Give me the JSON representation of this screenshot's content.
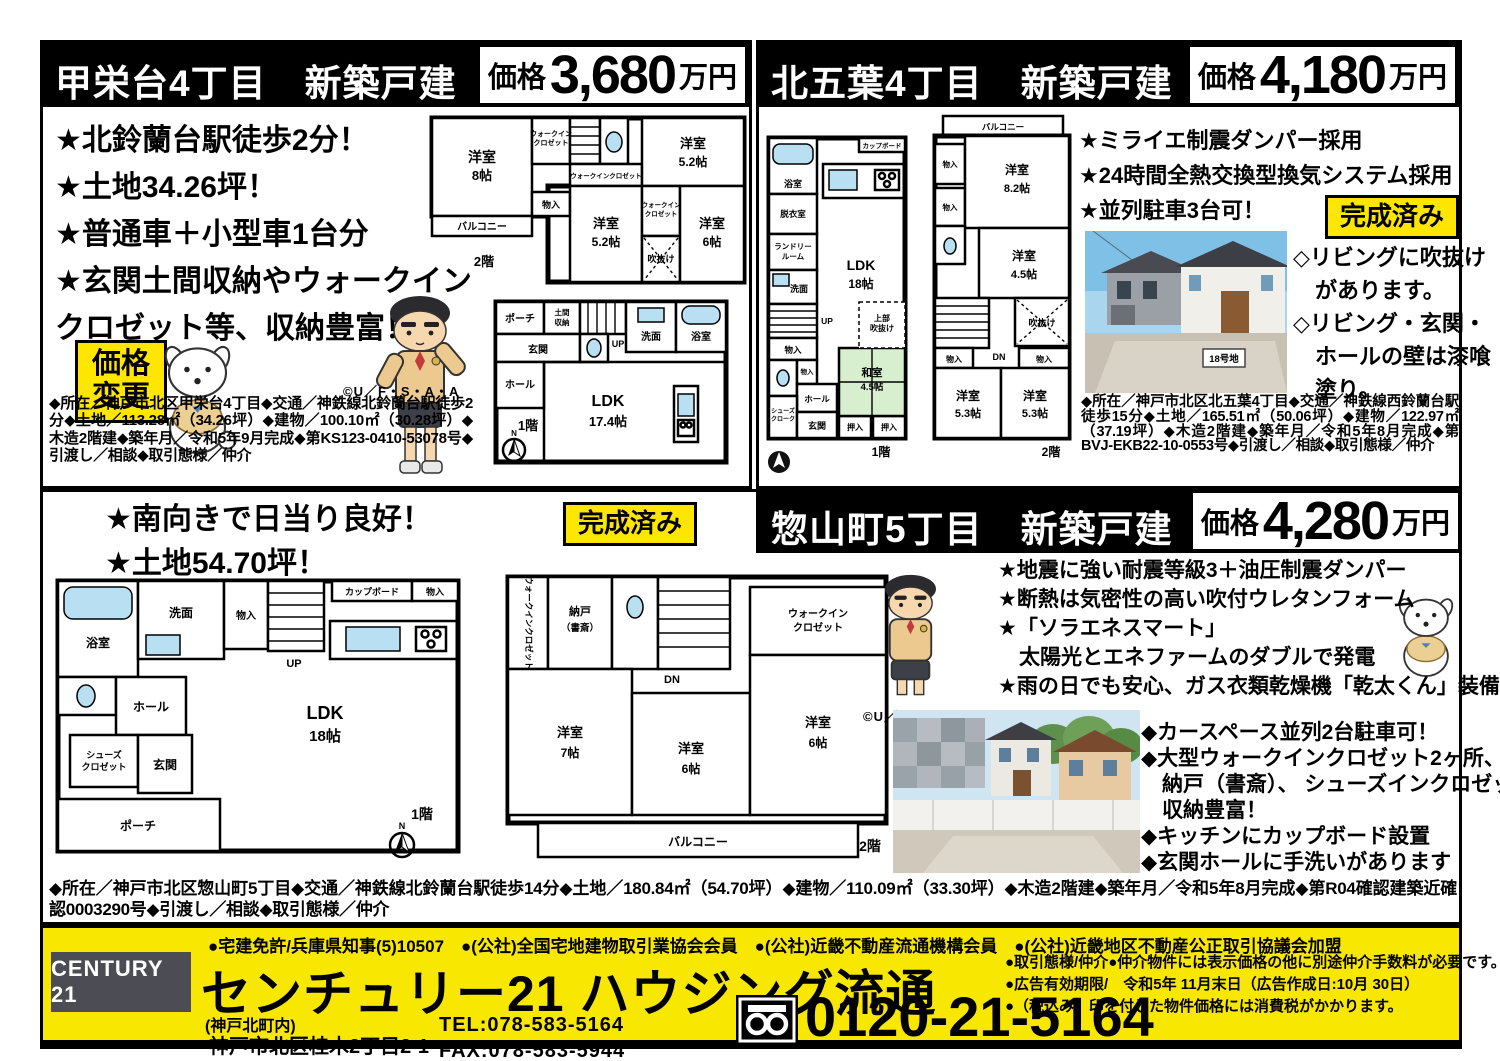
{
  "p1": {
    "title": "甲栄台4丁目　新築戸建",
    "price_label": "価格",
    "price": "3,680",
    "unit": "万円",
    "bullets": [
      "★北鈴蘭台駅徒歩2分！",
      "★土地34.26坪！",
      "★普通車＋小型車1台分",
      "★玄関土間収納やウォークイン",
      "クロゼット等、収納豊富！"
    ],
    "badge1": "価格",
    "badge2": "変更",
    "copyright": "©U／F・S・A・A",
    "details": "◆所在／神戸市北区甲栄台4丁目◆交通／神鉄線北鈴蘭台駅徒歩2分◆土地／113.28㎡（34.26坪）◆建物／100.10㎡（30.28坪）◆木造2階建◆築年月／令和5年9月完成◆第KS123-0410-53078号◆引渡し／相談◆取引態様／仲介",
    "plan2f": {
      "floor": "2階",
      "balcony": "バルコニー",
      "r1a": "洋室",
      "r1b": "8帖",
      "wic1a": "ウォークイン",
      "wic1b": "クロゼット",
      "wic2": "ウォークインクロゼット",
      "r2a": "洋室",
      "r2b": "5.2帖",
      "mono": "物入",
      "r3a": "洋室",
      "r3b": "5.2帖",
      "wic3a": "ウォークイン",
      "wic3b": "クロゼット",
      "void": "吹抜け",
      "r4a": "洋室",
      "r4b": "6帖"
    },
    "plan1f": {
      "floor": "1階",
      "porch": "ポーチ",
      "domaa": "土間",
      "domab": "収納",
      "genkan": "玄関",
      "up": "UP",
      "senmen": "洗面",
      "bath": "浴室",
      "hall": "ホール",
      "ldka": "LDK",
      "ldkb": "17.4帖",
      "north": "N"
    }
  },
  "p2": {
    "title": "北五葉4丁目　新築戸建",
    "price_label": "価格",
    "price": "4,180",
    "unit": "万円",
    "bullets": [
      "★ミライエ制震ダンパー採用",
      "★24時間全熱交換型換気システム採用",
      "★並列駐車3台可！"
    ],
    "badge": "完成済み",
    "sign": "18号地",
    "diamonds": [
      "◇リビングに吹抜け",
      "　があります。",
      "◇リビング・玄関・",
      "　ホールの壁は漆喰",
      "　塗り。"
    ],
    "details": "◆所在／神戸市北区北五葉4丁目◆交通／神鉄線西鈴蘭台駅徒歩15分◆土地／165.51㎡（50.06坪）◆建物／122.97㎡（37.19坪）◆木造2階建◆築年月／令和5年8月完成◆第BVJ-EKB22-10-0553号◆引渡し／相談◆取引態様／仲介",
    "plan": {
      "f1": "1階",
      "f2": "2階",
      "bath": "浴室",
      "datsui": "脱衣室",
      "laundrya": "ランドリー",
      "laundryb": "ルーム",
      "senmen": "洗面",
      "up": "UP",
      "mono1": "物入",
      "mono2": "物入",
      "hall": "ホール",
      "shoesa": "シューズ",
      "shoesb": "クローク",
      "genkan": "玄関",
      "oshi1": "押入",
      "oshi2": "押入",
      "washitsua": "和室",
      "washitsub": "4.5帖",
      "ldka": "LDK",
      "ldkb": "18帖",
      "cup": "カップボード",
      "voida": "上部",
      "voidb": "吹抜け",
      "balcony": "バルコニー",
      "mono3": "物入",
      "mono4": "物入",
      "r1a": "洋室",
      "r1b": "8.2帖",
      "r2a": "洋室",
      "r2b": "4.5帖",
      "void2": "吹抜け",
      "dn": "DN",
      "mono5": "物入",
      "mono6": "物入",
      "r3a": "洋室",
      "r3b": "5.3帖",
      "r4a": "洋室",
      "r4b": "5.3帖"
    }
  },
  "p3": {
    "title": "惣山町5丁目　新築戸建",
    "price_label": "価格",
    "price": "4,280",
    "unit": "万円",
    "left_bullets": [
      "★南向きで日当り良好！",
      "★土地54.70坪！"
    ],
    "badge": "完成済み",
    "bullets": [
      "★地震に強い耐震等級3＋油圧制震ダンパー",
      "★断熱は気密性の高い吹付ウレタンフォーム",
      "★「ソラエネスマート」",
      "　太陽光とエネファームのダブルで発電",
      "★雨の日でも安心、ガス衣類乾燥機「乾太くん」装備"
    ],
    "copyright": "©U／F・S・A・A",
    "diamonds": [
      "◆カースペース並列2台駐車可！",
      "◆大型ウォークインクロゼット2ヶ所、",
      "　納戸（書斎）、 シューズインクロゼットなど",
      "　収納豊富！",
      "◆キッチンにカップボード設置",
      "◆玄関ホールに手洗いがあります"
    ],
    "details": "◆所在／神戸市北区惣山町5丁目◆交通／神鉄線北鈴蘭台駅徒歩14分◆土地／180.84㎡（54.70坪）◆建物／110.09㎡（33.30坪）◆木造2階建◆築年月／令和5年8月完成◆第R04確認建築近確認0003290号◆引渡し／相談◆取引態様／仲介",
    "plan": {
      "f1": "1階",
      "f2": "2階",
      "bath": "浴室",
      "senmen": "洗面",
      "mono1": "物入",
      "up": "UP",
      "cup": "カップボード",
      "mono2": "物入",
      "hall": "ホール",
      "shoesa": "シューズ",
      "shoesb": "クロゼット",
      "genkan": "玄関",
      "porch": "ポーチ",
      "ldka": "LDK",
      "ldkb": "18帖",
      "wic1": "ウォークインクロゼット",
      "nandoa": "納戸",
      "nandob": "（書斎）",
      "dn": "DN",
      "wic2a": "ウォークイン",
      "wic2b": "クロゼット",
      "r1a": "洋室",
      "r1b": "7帖",
      "r2a": "洋室",
      "r2b": "6帖",
      "r3a": "洋室",
      "r3b": "6帖",
      "balcony": "バルコニー",
      "north": "N"
    }
  },
  "footer": {
    "memberships": "●宅建免許/兵庫県知事(5)10507　●(公社)全国宅地建物取引業協会会員　●(公社)近畿不動産流通機構会員　●(公社)近畿地区不動産公正取引協議会加盟",
    "logo": "CENTURY 21",
    "company": "センチュリー21 ハウジング流通",
    "branch": "(神戸北町内)",
    "address": "神戸市北区桂木2丁目2-1",
    "tel": "TEL:078-583-5164",
    "fax": "FAX:078-583-5944",
    "notes": [
      "●取引態様/仲介●仲介物件には表示価格の他に別途仲介手数料が必要です。",
      "●広告有効期限/　令和5年 11月末日（広告作成日:10月 30日）",
      "●（税込み）印を付した物件価格には消費税がかかります。"
    ],
    "freedial": "0120-21-5164"
  }
}
